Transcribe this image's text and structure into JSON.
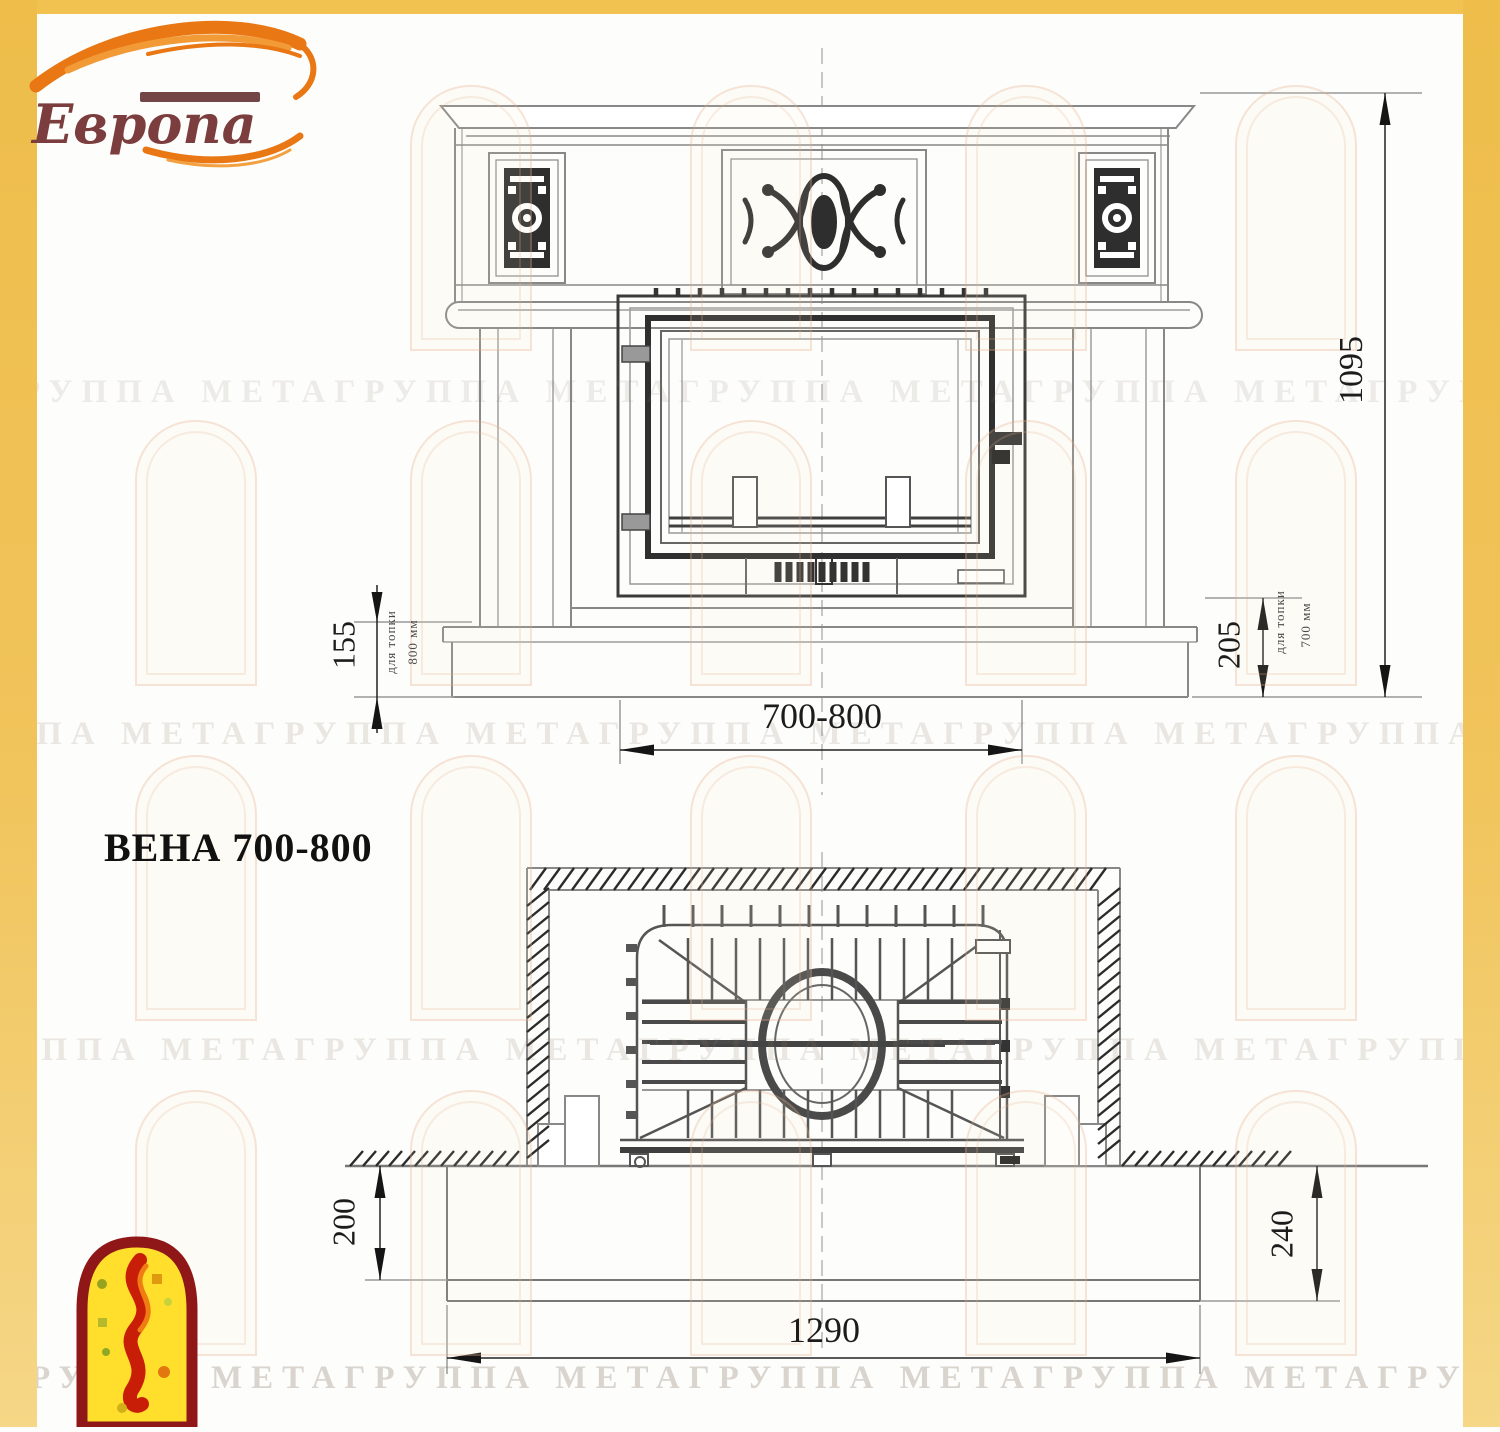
{
  "brand": {
    "name": "Европа"
  },
  "title": "ВЕНА 700-800",
  "watermark_text": "ГРУППА МЕТАГРУППА МЕТАГРУППА МЕТАГРУППА МЕТАГРУППА МЕТАГРУППА МЕТА",
  "front_view": {
    "overall_height": "1095",
    "hearth_height_left": "155",
    "hearth_left_note": {
      "line1": "для топки",
      "line2": "800 мм"
    },
    "hearth_height_right": "205",
    "hearth_right_note": {
      "line1": "для топки",
      "line2": "700 мм"
    },
    "firebox_width_range": "700-800"
  },
  "plan_view": {
    "hearth_depth_left": "200",
    "hearth_depth_right": "240",
    "overall_width": "1290"
  },
  "colors": {
    "frame_yellow": "#f1c24f",
    "logo_orange": "#e87714",
    "logo_text_red": "#7b3d3d",
    "drawing_line_gray": "#888888",
    "dark_detail": "#2f2f2f"
  }
}
